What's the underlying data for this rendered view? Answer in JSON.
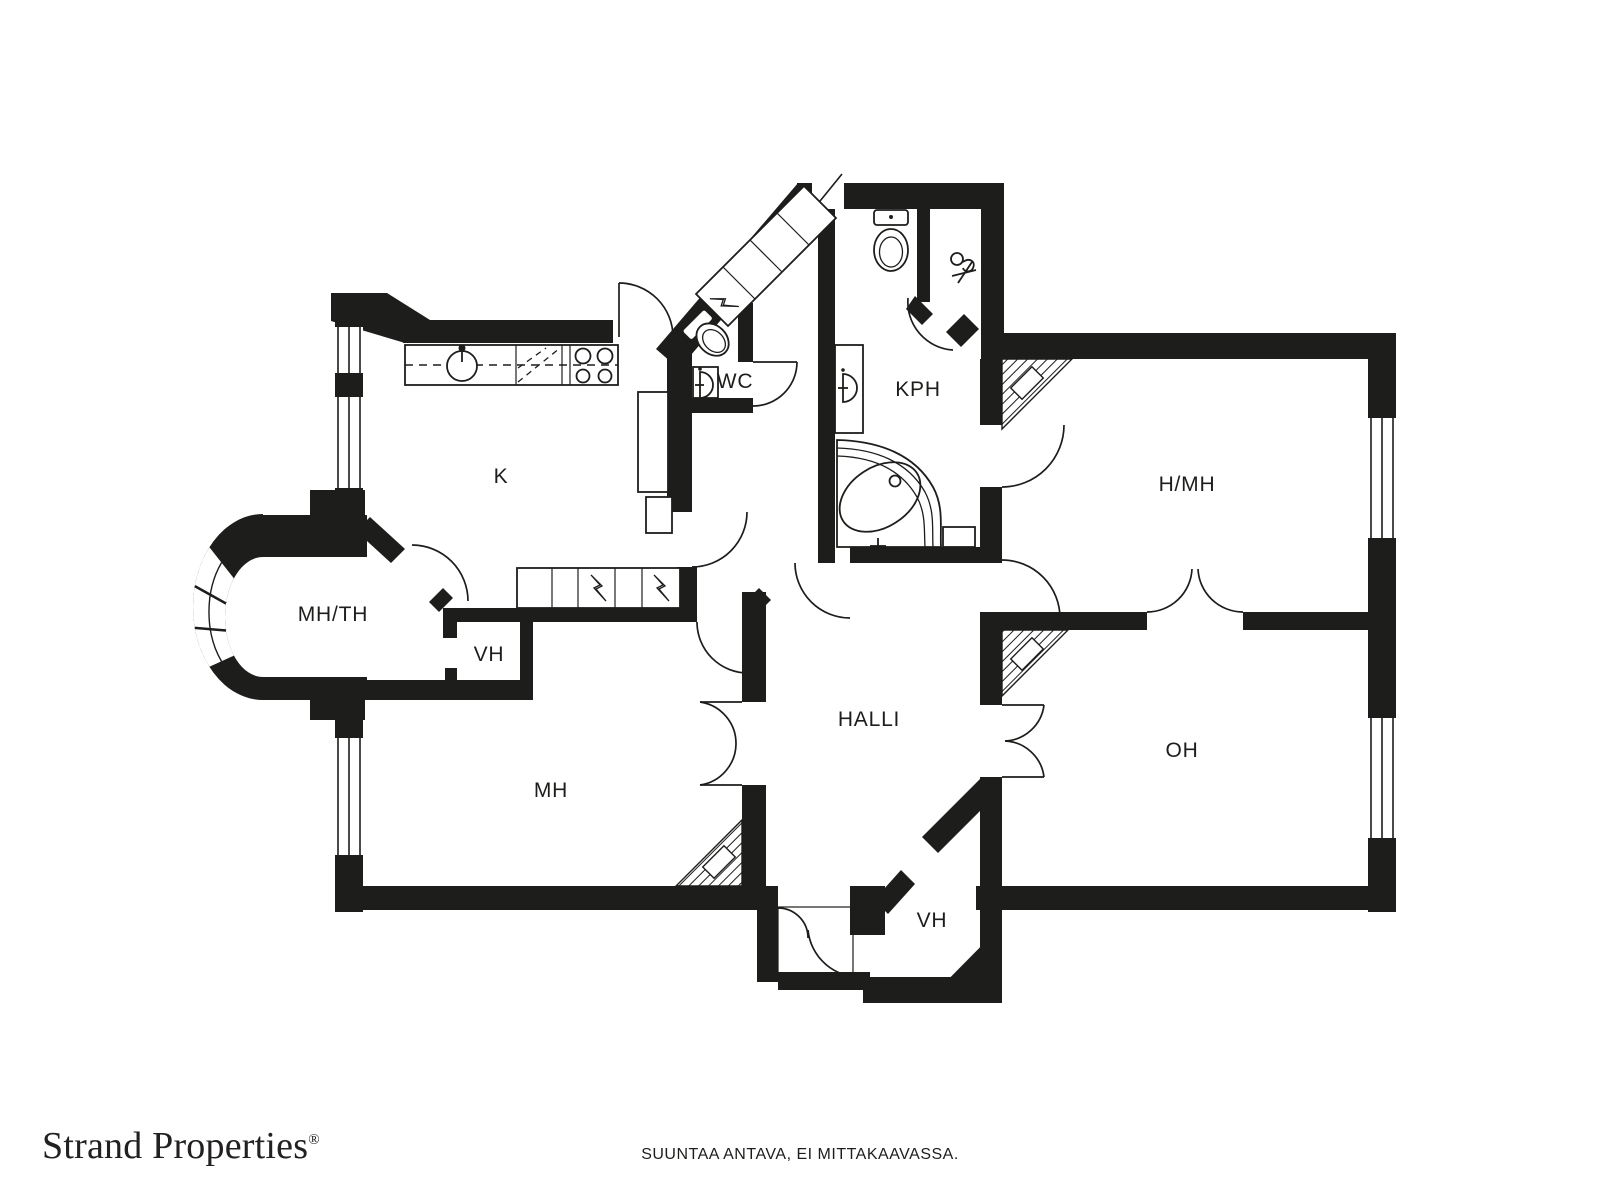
{
  "branding": {
    "name": "Strand Properties",
    "registered_mark": "®"
  },
  "disclaimer": "SUUNTAA ANTAVA, EI MITTAKAAVASSA.",
  "floorplan": {
    "rooms": [
      {
        "id": "kitchen",
        "label": "K"
      },
      {
        "id": "wc",
        "label": "WC"
      },
      {
        "id": "bathroom",
        "label": "KPH"
      },
      {
        "id": "room-h-mh",
        "label": "H/MH"
      },
      {
        "id": "room-mh-th",
        "label": "MH/TH"
      },
      {
        "id": "closet-upper",
        "label": "VH"
      },
      {
        "id": "bedroom-mh",
        "label": "MH"
      },
      {
        "id": "hall",
        "label": "HALLI"
      },
      {
        "id": "living-room-oh",
        "label": "OH"
      },
      {
        "id": "vestibule-vh",
        "label": "VH"
      }
    ],
    "colors": {
      "wall": "#1d1d1b",
      "line": "#1d1d1b",
      "floor": "#ffffff"
    },
    "fixtures": [
      "toilet",
      "washbasin",
      "corner-bathtub",
      "kitchen-sink",
      "cooktop",
      "dishwasher",
      "refrigerator",
      "wardrobe",
      "tile-stove",
      "window",
      "door",
      "hand-shower"
    ]
  }
}
